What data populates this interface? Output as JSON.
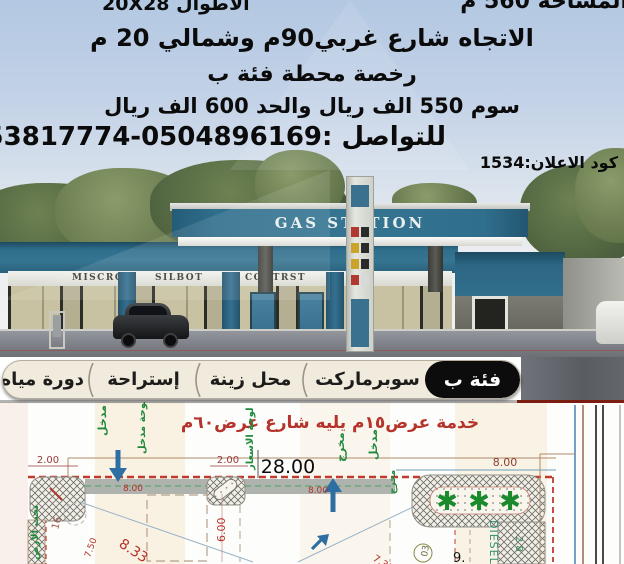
{
  "header": {
    "area": "المساحة 560 م",
    "lengths": "الأطوال 20X28",
    "direction": "الاتجاه شارع غربي90م وشمالي 20 م",
    "license": "رخصة محطة فئة ب",
    "price": "سوم 550 الف ريال والحد 600 الف ريال",
    "contact": "للتواصل :0504896169-0553817774",
    "ad_code": "كود الاعلان:1534"
  },
  "station": {
    "canopy_sign": "GAS STATION",
    "shop_signs": [
      "MISCRO",
      "SILBOT",
      "CONTRST",
      "GL"
    ]
  },
  "tabs": {
    "category": "فئة ب",
    "items": [
      "سوبرماركت",
      "محل زينة",
      "إستراحة",
      "دورة مياه"
    ]
  },
  "plan": {
    "title": "خدمة عرض١٥م يليه شارع عرض٦٠م",
    "dims": {
      "d28": "28.00",
      "d2a": "2.00",
      "d2b": "2.00",
      "d8a": "8.00",
      "d8b": "8.00",
      "d8c": "8.00",
      "d6": "6.00",
      "d833": "8.33",
      "d750": "7.50",
      "d731": "7.31",
      "d16": "16",
      "d28g": "2.8",
      "d9": "9.",
      "d03": "03"
    },
    "labels": {
      "entrance": "مدخل",
      "entrance_board": "لوحة مدخل",
      "exit": "مخرج",
      "price_board": "لوحة الاسعار",
      "underground": "تحت الارض",
      "diesel": "DIESEL"
    },
    "tree_icon": "✱"
  },
  "colors": {
    "teal": "#2f6e8c",
    "sky_top": "#b3c8e2",
    "tab_bg": "#f0ebdd",
    "tab_black": "#0c0c0c",
    "plan_title_red": "#b5332a",
    "dim_red": "#9c3a3c",
    "label_green": "#1f8a3c",
    "arrow_blue": "#2d6fa3",
    "dashed_red": "#c03a2e"
  }
}
